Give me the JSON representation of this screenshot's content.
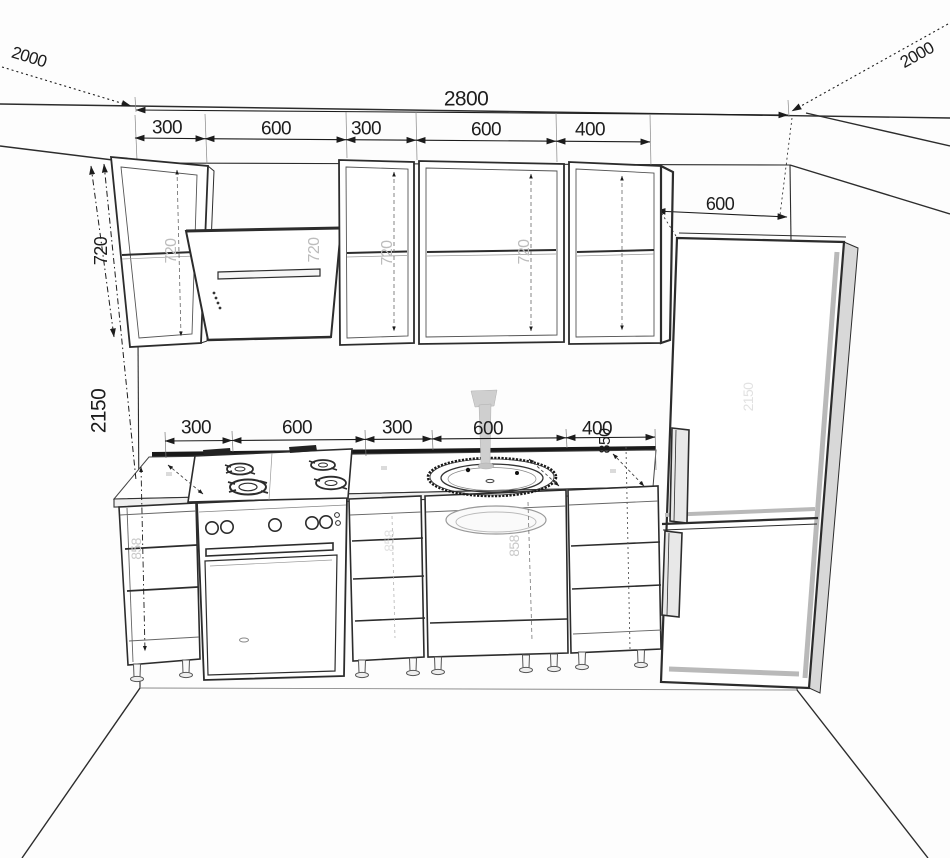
{
  "drawing": {
    "type": "kitchen elevation technical drawing",
    "units": "mm"
  },
  "dimensions": {
    "overall_width": "2800",
    "left_wall_depth": "2000",
    "right_wall_depth": "2000",
    "top_segments": [
      "300",
      "600",
      "300",
      "600",
      "400"
    ],
    "counter_segments": [
      "300",
      "600",
      "300",
      "600",
      "400"
    ],
    "fridge_width": "600",
    "wall_cabinet_height": "720",
    "total_height": "2150",
    "counter_height": "850"
  },
  "watermarks": {
    "wall_cabinet_height": "720",
    "base_cabinet_height": "858",
    "tall_unit_height": "2150"
  },
  "colors": {
    "line": "#2c2c2c",
    "dim_text": "#1d1d1d",
    "watermark": "#bcbcbc",
    "backsplash": "#191919",
    "fridge_side": "#d8d8d8",
    "faucet": "#cfcfcf",
    "background": "#fdfdfd"
  }
}
